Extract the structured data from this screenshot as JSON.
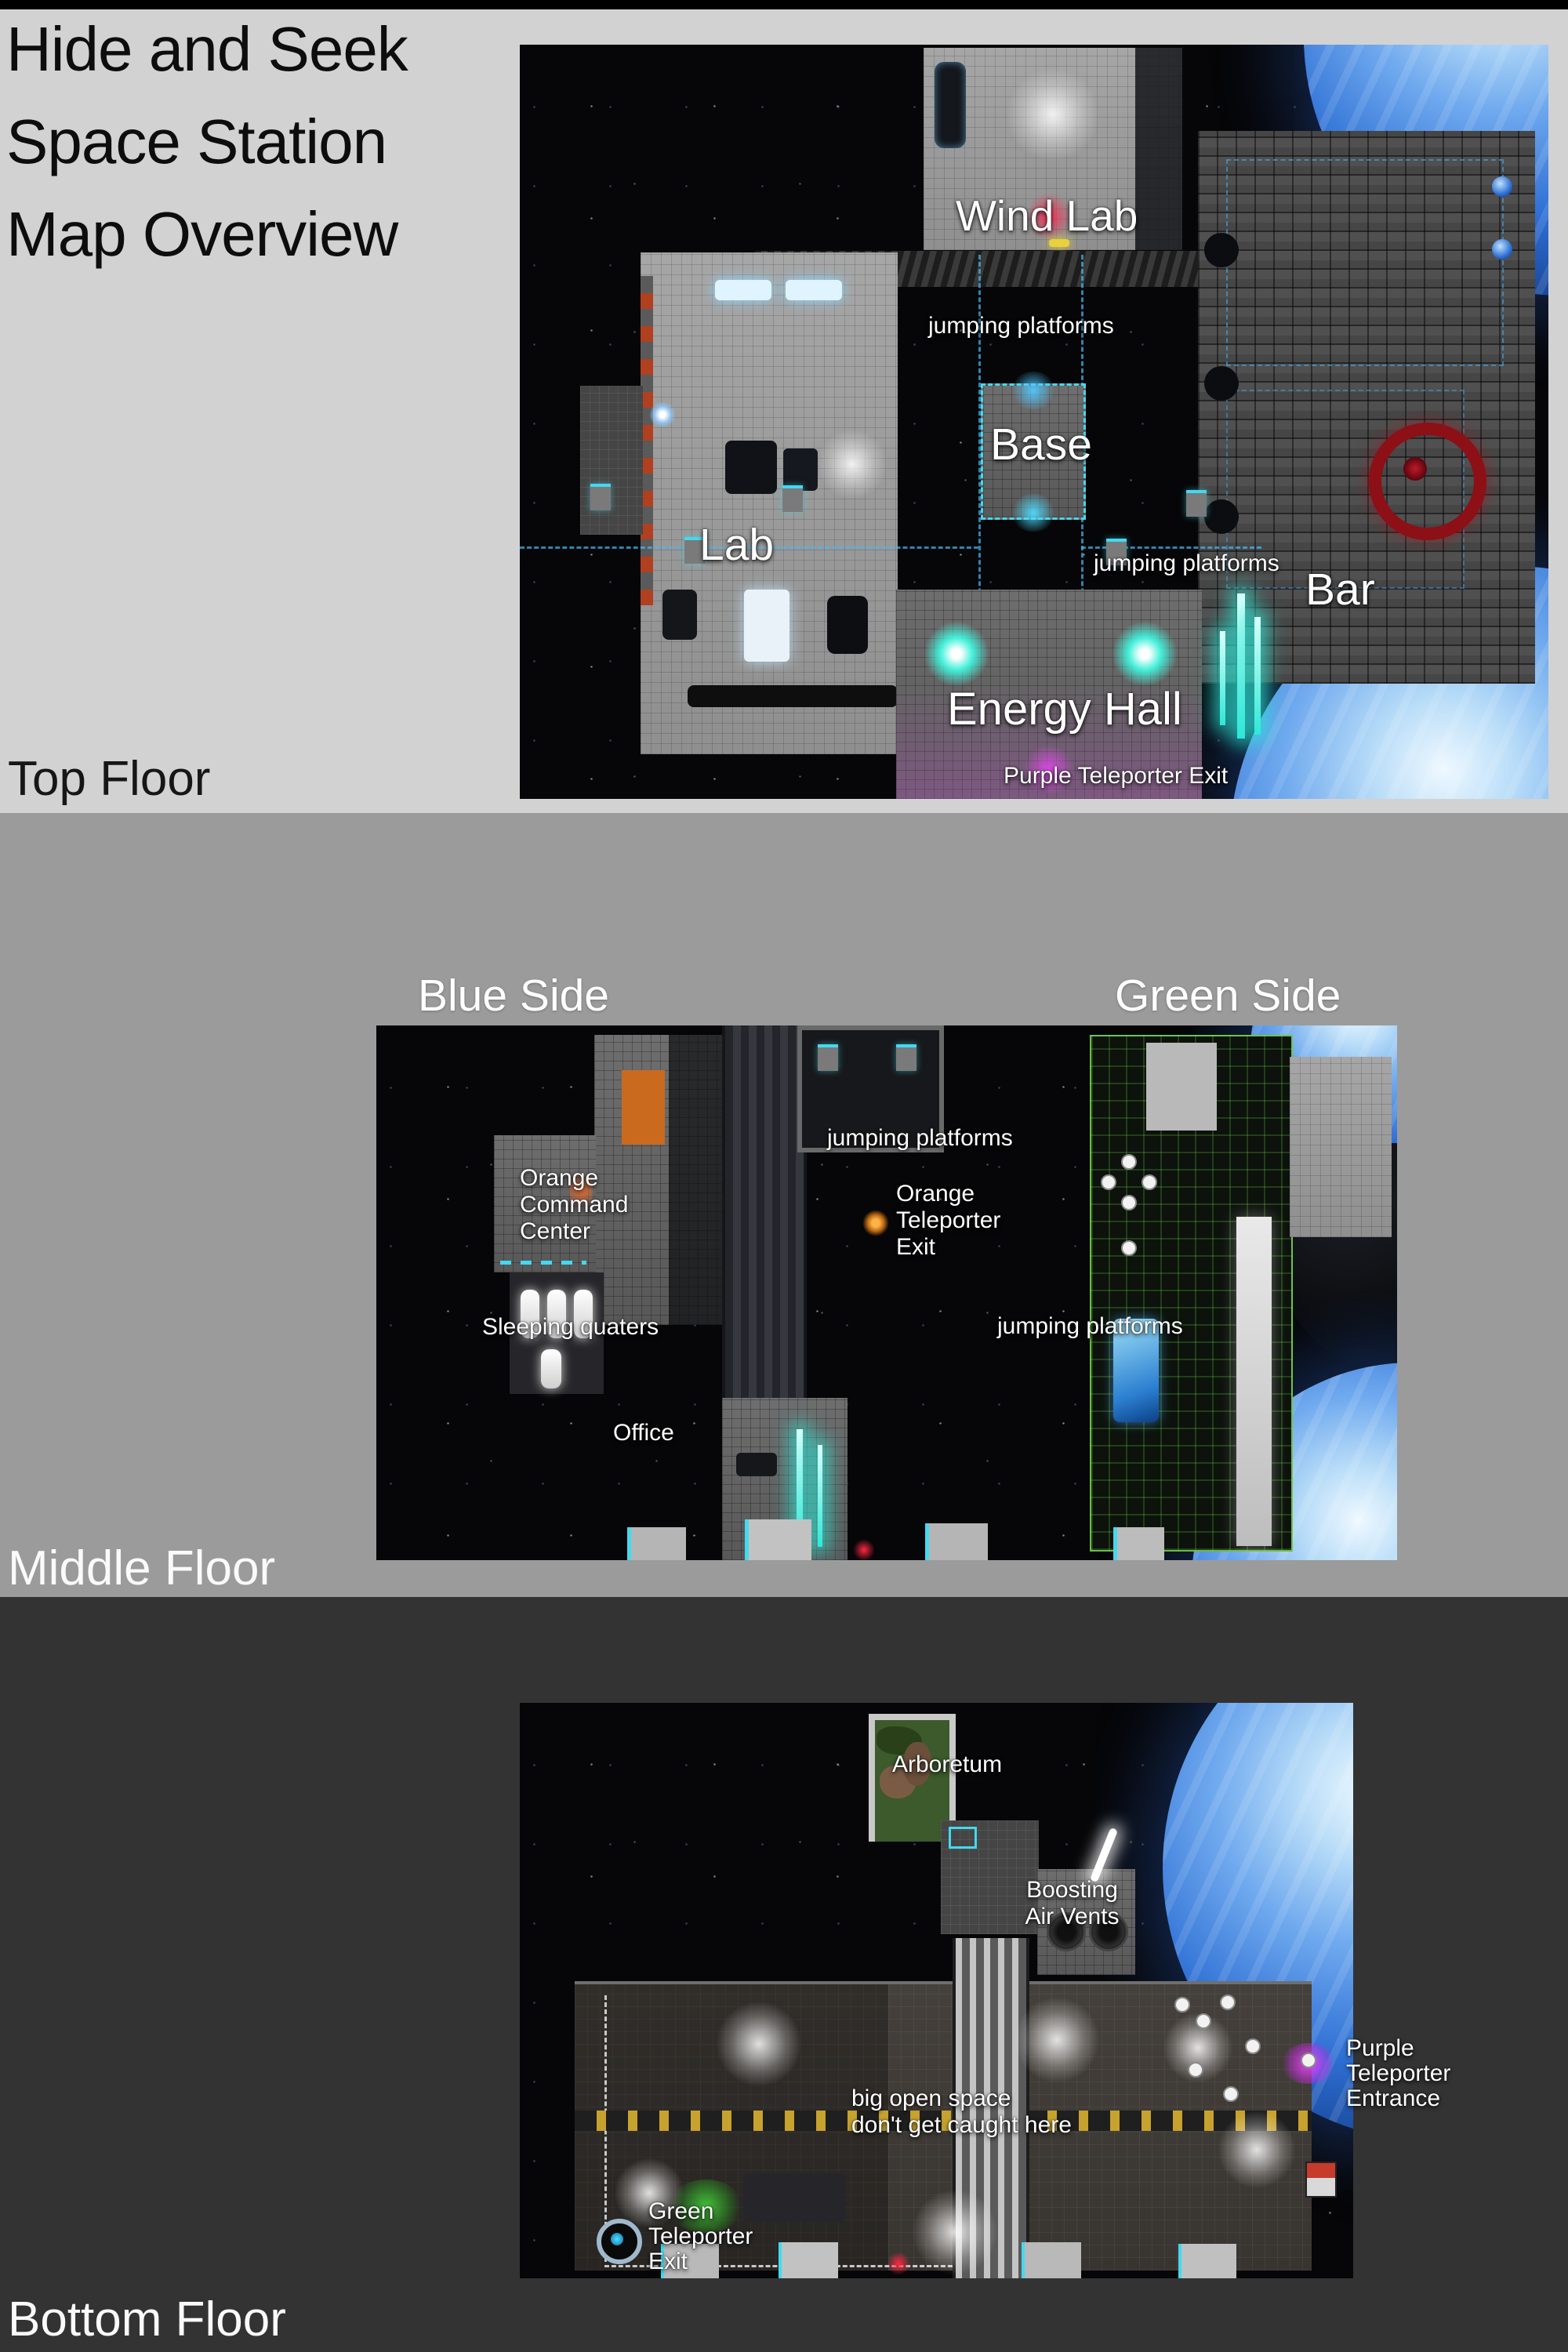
{
  "title": "Hide and Seek\nSpace Station\nMap Overview",
  "floors": {
    "top": {
      "label": "Top Floor",
      "map_labels": {
        "wind_lab": "Wind Lab",
        "jumping_platforms_upper": "jumping platforms",
        "base": "Base",
        "lab": "Lab",
        "jumping_platforms_lower": "jumping platforms",
        "bar": "Bar",
        "energy_hall": "Energy Hall",
        "purple_teleporter_exit": "Purple Teleporter Exit"
      }
    },
    "middle": {
      "label": "Middle Floor",
      "blue_side": "Blue Side",
      "green_side": "Green Side",
      "map_labels": {
        "jumping_platforms_upper": "jumping platforms",
        "orange_teleporter_exit": "Orange\nTeleporter\nExit",
        "orange_command_center": "Orange\nCommand\nCenter",
        "sleeping_quaters": "Sleeping quaters",
        "office": "Office",
        "jumping_platforms_lower": "jumping platforms"
      }
    },
    "bottom": {
      "label": "Bottom Floor",
      "map_labels": {
        "arboretum": "Arboretum",
        "boosting_air_vents": "Boosting\nAir Vents",
        "big_open_space": "big open space\ndon't get caught here",
        "green_teleporter_exit": "Green\nTeleporter\nExit",
        "purple_teleporter_entrance": "Purple\nTeleporter\nEntrance"
      }
    }
  },
  "colors": {
    "section_top_bg": "#d2d2d2",
    "section_middle_bg": "#9b9b9b",
    "section_bottom_bg": "#333333",
    "earth_blue": "#2e6fd4",
    "accent_cyan": "#43d9f0",
    "accent_teal": "#2fe8d8",
    "accent_magenta": "#e23bf0",
    "accent_green": "#3ec93a",
    "accent_red": "#8c1016",
    "accent_orange": "#c96a1e",
    "label_white": "#ffffff",
    "title_black": "#0d0d0d"
  }
}
